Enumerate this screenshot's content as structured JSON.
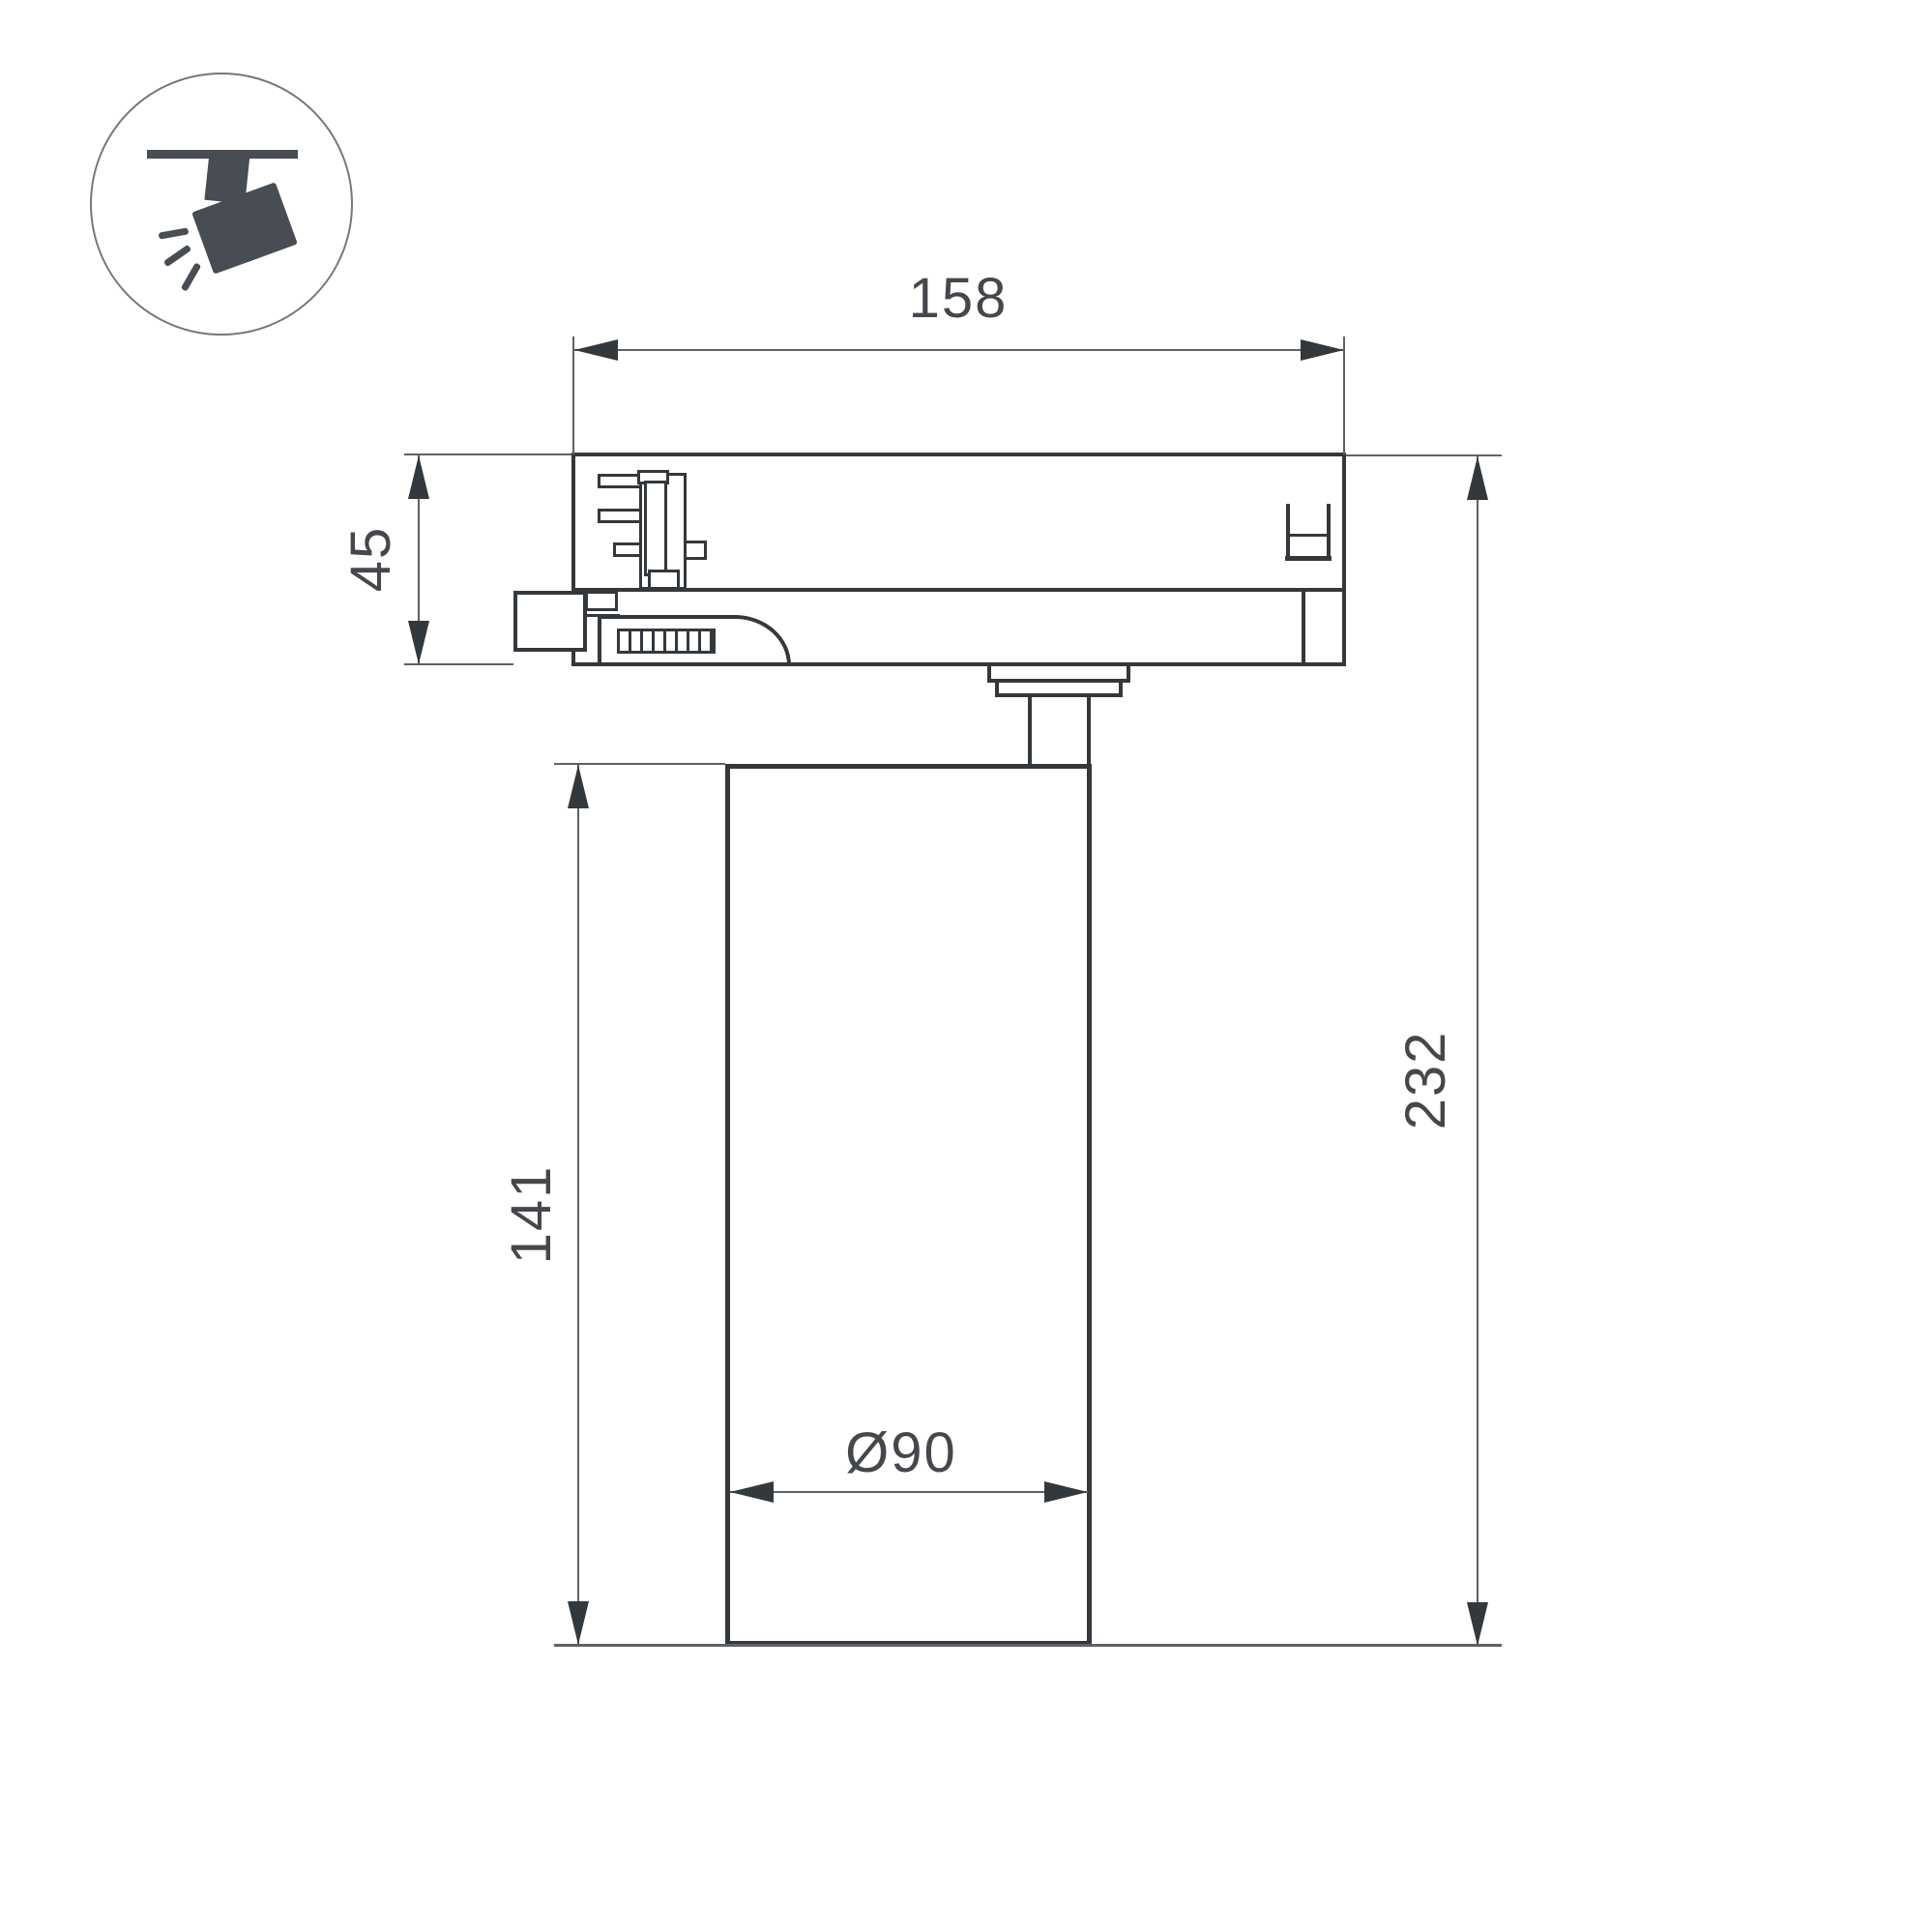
{
  "icon": {
    "name": "track-spotlight-icon"
  },
  "dimensions": {
    "adapter_width": {
      "label": "158"
    },
    "adapter_height": {
      "label": "45"
    },
    "body_height": {
      "label": "141"
    },
    "overall_height": {
      "label": "232"
    },
    "body_diameter": {
      "label": "Ø90"
    }
  },
  "colors": {
    "outline_dark": "#33383c",
    "dimension_line": "#5e6266",
    "text": "#44484c",
    "icon_fill": "#474d53",
    "background": "#ffffff"
  }
}
